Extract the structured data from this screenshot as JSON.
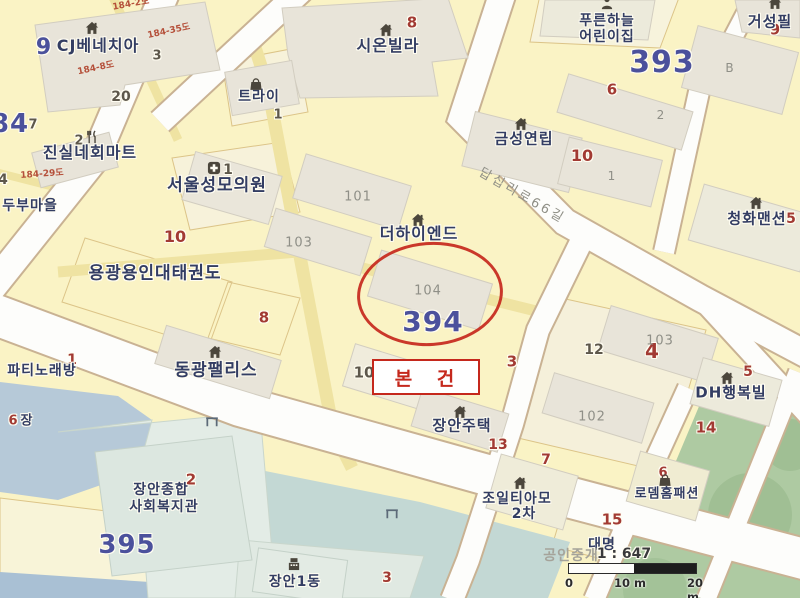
{
  "map": {
    "annotations": {
      "subject_label": "본 건",
      "highlight_color": "#c5281c"
    },
    "scale": {
      "watermark": "공인중개",
      "ratio_label": "1 : 647",
      "ticks": [
        "0",
        "10 m",
        "20 m"
      ]
    },
    "colors": {
      "parcel": "#faf3c5",
      "road": "#fdfdfb",
      "building": "#e8e4d9",
      "water": "#b6c9d8",
      "stream": "#c3d8d4",
      "park": "#aecaa2",
      "block_number": "#4b519c",
      "parcel_number_red": "#a23a33",
      "highlight": "#c5281c"
    },
    "labels": [
      {
        "text": "84",
        "x": 10,
        "y": 124,
        "cls": "block halo",
        "s": 26
      },
      {
        "text": "9",
        "x": 44,
        "y": 48,
        "cls": "block halo",
        "s": 22
      },
      {
        "text": "393",
        "x": 662,
        "y": 63,
        "cls": "block halo",
        "s": 30
      },
      {
        "text": "394",
        "x": 433,
        "y": 322,
        "cls": "block halo",
        "s": 28
      },
      {
        "text": "395",
        "x": 127,
        "y": 545,
        "cls": "block halo",
        "s": 26
      },
      {
        "text": "8",
        "x": 412,
        "y": 23,
        "cls": "num-red halo",
        "s": 15
      },
      {
        "text": "9",
        "x": 775,
        "y": 30,
        "cls": "num-red halo",
        "s": 15
      },
      {
        "text": "6",
        "x": 612,
        "y": 90,
        "cls": "num-red halo",
        "s": 15
      },
      {
        "text": "10",
        "x": 582,
        "y": 156,
        "cls": "num-red halo",
        "s": 16
      },
      {
        "text": "5",
        "x": 791,
        "y": 219,
        "cls": "num-red halo",
        "s": 14
      },
      {
        "text": "10",
        "x": 175,
        "y": 237,
        "cls": "num-red halo",
        "s": 16
      },
      {
        "text": "8",
        "x": 264,
        "y": 318,
        "cls": "num-red halo",
        "s": 15
      },
      {
        "text": "1",
        "x": 72,
        "y": 360,
        "cls": "num-red halo",
        "s": 14
      },
      {
        "text": "6",
        "x": 13,
        "y": 421,
        "cls": "num-red halo",
        "s": 13
      },
      {
        "text": "2",
        "x": 191,
        "y": 480,
        "cls": "num-red halo",
        "s": 15
      },
      {
        "text": "3",
        "x": 512,
        "y": 362,
        "cls": "num-red halo",
        "s": 15
      },
      {
        "text": "4",
        "x": 652,
        "y": 351,
        "cls": "num-red halo",
        "s": 20
      },
      {
        "text": "5",
        "x": 748,
        "y": 372,
        "cls": "num-red halo",
        "s": 14
      },
      {
        "text": "14",
        "x": 706,
        "y": 428,
        "cls": "num-red halo",
        "s": 15
      },
      {
        "text": "13",
        "x": 498,
        "y": 445,
        "cls": "num-red halo",
        "s": 14
      },
      {
        "text": "7",
        "x": 546,
        "y": 460,
        "cls": "num-red halo",
        "s": 14
      },
      {
        "text": "6",
        "x": 663,
        "y": 473,
        "cls": "num-red halo",
        "s": 13
      },
      {
        "text": "15",
        "x": 612,
        "y": 520,
        "cls": "num-red halo",
        "s": 15
      },
      {
        "text": "3",
        "x": 387,
        "y": 578,
        "cls": "num-red halo",
        "s": 14
      },
      {
        "text": "3",
        "x": 157,
        "y": 56,
        "cls": "num-dark halo",
        "s": 13
      },
      {
        "text": "20",
        "x": 121,
        "y": 97,
        "cls": "num-dark halo",
        "s": 14
      },
      {
        "text": "7",
        "x": 33,
        "y": 125,
        "cls": "num-dark halo",
        "s": 13
      },
      {
        "text": "4",
        "x": 3,
        "y": 180,
        "cls": "num-dark halo",
        "s": 14
      },
      {
        "text": "2",
        "x": 79,
        "y": 141,
        "cls": "num-dark halo",
        "s": 13
      },
      {
        "text": "1",
        "x": 228,
        "y": 170,
        "cls": "num-dark halo",
        "s": 14
      },
      {
        "text": "1",
        "x": 278,
        "y": 115,
        "cls": "num-dark halo",
        "s": 13
      },
      {
        "text": "10",
        "x": 364,
        "y": 373,
        "cls": "num-dark halo",
        "s": 15
      },
      {
        "text": "12",
        "x": 594,
        "y": 350,
        "cls": "num-dark halo",
        "s": 14
      },
      {
        "text": "101",
        "x": 358,
        "y": 197,
        "cls": "num-grey",
        "s": 13
      },
      {
        "text": "103",
        "x": 299,
        "y": 243,
        "cls": "num-grey",
        "s": 13
      },
      {
        "text": "104",
        "x": 428,
        "y": 291,
        "cls": "num-grey",
        "s": 13
      },
      {
        "text": "B",
        "x": 730,
        "y": 68,
        "cls": "num-grey",
        "s": 12
      },
      {
        "text": "2",
        "x": 661,
        "y": 115,
        "cls": "num-grey",
        "s": 12
      },
      {
        "text": "1",
        "x": 612,
        "y": 176,
        "cls": "num-grey",
        "s": 12
      },
      {
        "text": "102",
        "x": 592,
        "y": 417,
        "cls": "num-grey",
        "s": 13
      },
      {
        "text": "103",
        "x": 660,
        "y": 341,
        "cls": "num-grey",
        "s": 13
      },
      {
        "text": "CJ베네치아",
        "x": 98,
        "y": 46,
        "cls": "place halo",
        "s": 16
      },
      {
        "text": "시온빌라",
        "x": 388,
        "y": 46,
        "cls": "place halo",
        "s": 16
      },
      {
        "text": "트라이",
        "x": 259,
        "y": 97,
        "cls": "place halo",
        "s": 14
      },
      {
        "text": "푸른하늘",
        "x": 607,
        "y": 21,
        "cls": "place halo",
        "s": 14
      },
      {
        "text": "어린이집",
        "x": 607,
        "y": 37,
        "cls": "place halo",
        "s": 14
      },
      {
        "text": "거성필",
        "x": 770,
        "y": 22,
        "cls": "place halo",
        "s": 15
      },
      {
        "text": "금성연립",
        "x": 524,
        "y": 139,
        "cls": "place halo",
        "s": 15
      },
      {
        "text": "진실네회마트",
        "x": 90,
        "y": 153,
        "cls": "place halo",
        "s": 16
      },
      {
        "text": "두부마을",
        "x": 30,
        "y": 206,
        "cls": "place halo",
        "s": 14
      },
      {
        "text": "서울성모의원",
        "x": 217,
        "y": 186,
        "cls": "place halo",
        "s": 17
      },
      {
        "text": "청화맨션",
        "x": 757,
        "y": 219,
        "cls": "place halo",
        "s": 15
      },
      {
        "text": "더하이엔드",
        "x": 419,
        "y": 234,
        "cls": "place halo",
        "s": 16
      },
      {
        "text": "용광용인대태권도",
        "x": 155,
        "y": 274,
        "cls": "place halo",
        "s": 17
      },
      {
        "text": "동광팰리스",
        "x": 216,
        "y": 371,
        "cls": "place halo",
        "s": 17
      },
      {
        "text": "파티노래방",
        "x": 42,
        "y": 371,
        "cls": "place halo",
        "s": 14
      },
      {
        "text": "장안주택",
        "x": 462,
        "y": 426,
        "cls": "place halo",
        "s": 15
      },
      {
        "text": "DH행복빌",
        "x": 731,
        "y": 393,
        "cls": "place halo",
        "s": 15
      },
      {
        "text": "조일티아모",
        "x": 517,
        "y": 499,
        "cls": "place halo",
        "s": 14
      },
      {
        "text": "2차",
        "x": 524,
        "y": 514,
        "cls": "place halo",
        "s": 14
      },
      {
        "text": "로뎀홈패션",
        "x": 667,
        "y": 494,
        "cls": "place halo",
        "s": 13
      },
      {
        "text": "대명",
        "x": 602,
        "y": 545,
        "cls": "place halo",
        "s": 14
      },
      {
        "text": "장안종합",
        "x": 161,
        "y": 490,
        "cls": "place halo",
        "s": 14
      },
      {
        "text": "사회복지관",
        "x": 164,
        "y": 507,
        "cls": "place halo",
        "s": 14
      },
      {
        "text": "장안1동",
        "x": 295,
        "y": 582,
        "cls": "place halo",
        "s": 14
      },
      {
        "text": "장",
        "x": 27,
        "y": 421,
        "cls": "place halo",
        "s": 13
      },
      {
        "text": "184-2도",
        "x": 131,
        "y": 5,
        "cls": "lot",
        "s": 9,
        "r": -10
      },
      {
        "text": "184-35도",
        "x": 169,
        "y": 32,
        "cls": "lot",
        "s": 9,
        "r": -12
      },
      {
        "text": "184-8도",
        "x": 96,
        "y": 69,
        "cls": "lot",
        "s": 9,
        "r": -12
      },
      {
        "text": "184-29도",
        "x": 42,
        "y": 175,
        "cls": "lot",
        "s": 9,
        "r": -4
      },
      {
        "text": "답십리로66길",
        "x": 522,
        "y": 196,
        "cls": "roadname",
        "s": 13,
        "r": 30
      },
      {
        "text": "공인중개",
        "x": 571,
        "y": 556,
        "cls": "watermark",
        "s": 14
      },
      {
        "text": "1 : 647",
        "x": 624,
        "y": 554,
        "cls": "ratio halo",
        "s": 14
      }
    ],
    "icons": [
      {
        "icon": "house",
        "x": 92,
        "y": 28
      },
      {
        "icon": "house",
        "x": 386,
        "y": 30
      },
      {
        "icon": "house",
        "x": 775,
        "y": 3
      },
      {
        "icon": "house",
        "x": 521,
        "y": 124
      },
      {
        "icon": "house",
        "x": 418,
        "y": 220
      },
      {
        "icon": "house",
        "x": 756,
        "y": 203
      },
      {
        "icon": "house",
        "x": 215,
        "y": 352
      },
      {
        "icon": "house",
        "x": 460,
        "y": 412
      },
      {
        "icon": "house",
        "x": 727,
        "y": 378
      },
      {
        "icon": "house",
        "x": 520,
        "y": 483
      },
      {
        "icon": "bag",
        "x": 256,
        "y": 84
      },
      {
        "icon": "bag",
        "x": 665,
        "y": 480
      },
      {
        "icon": "restaurant",
        "x": 92,
        "y": 137
      },
      {
        "icon": "hospital",
        "x": 214,
        "y": 168
      },
      {
        "icon": "person",
        "x": 607,
        "y": 3
      },
      {
        "icon": "office",
        "x": 294,
        "y": 564
      },
      {
        "icon": "bridge",
        "x": 212,
        "y": 421
      },
      {
        "icon": "bridge",
        "x": 392,
        "y": 513
      }
    ]
  }
}
